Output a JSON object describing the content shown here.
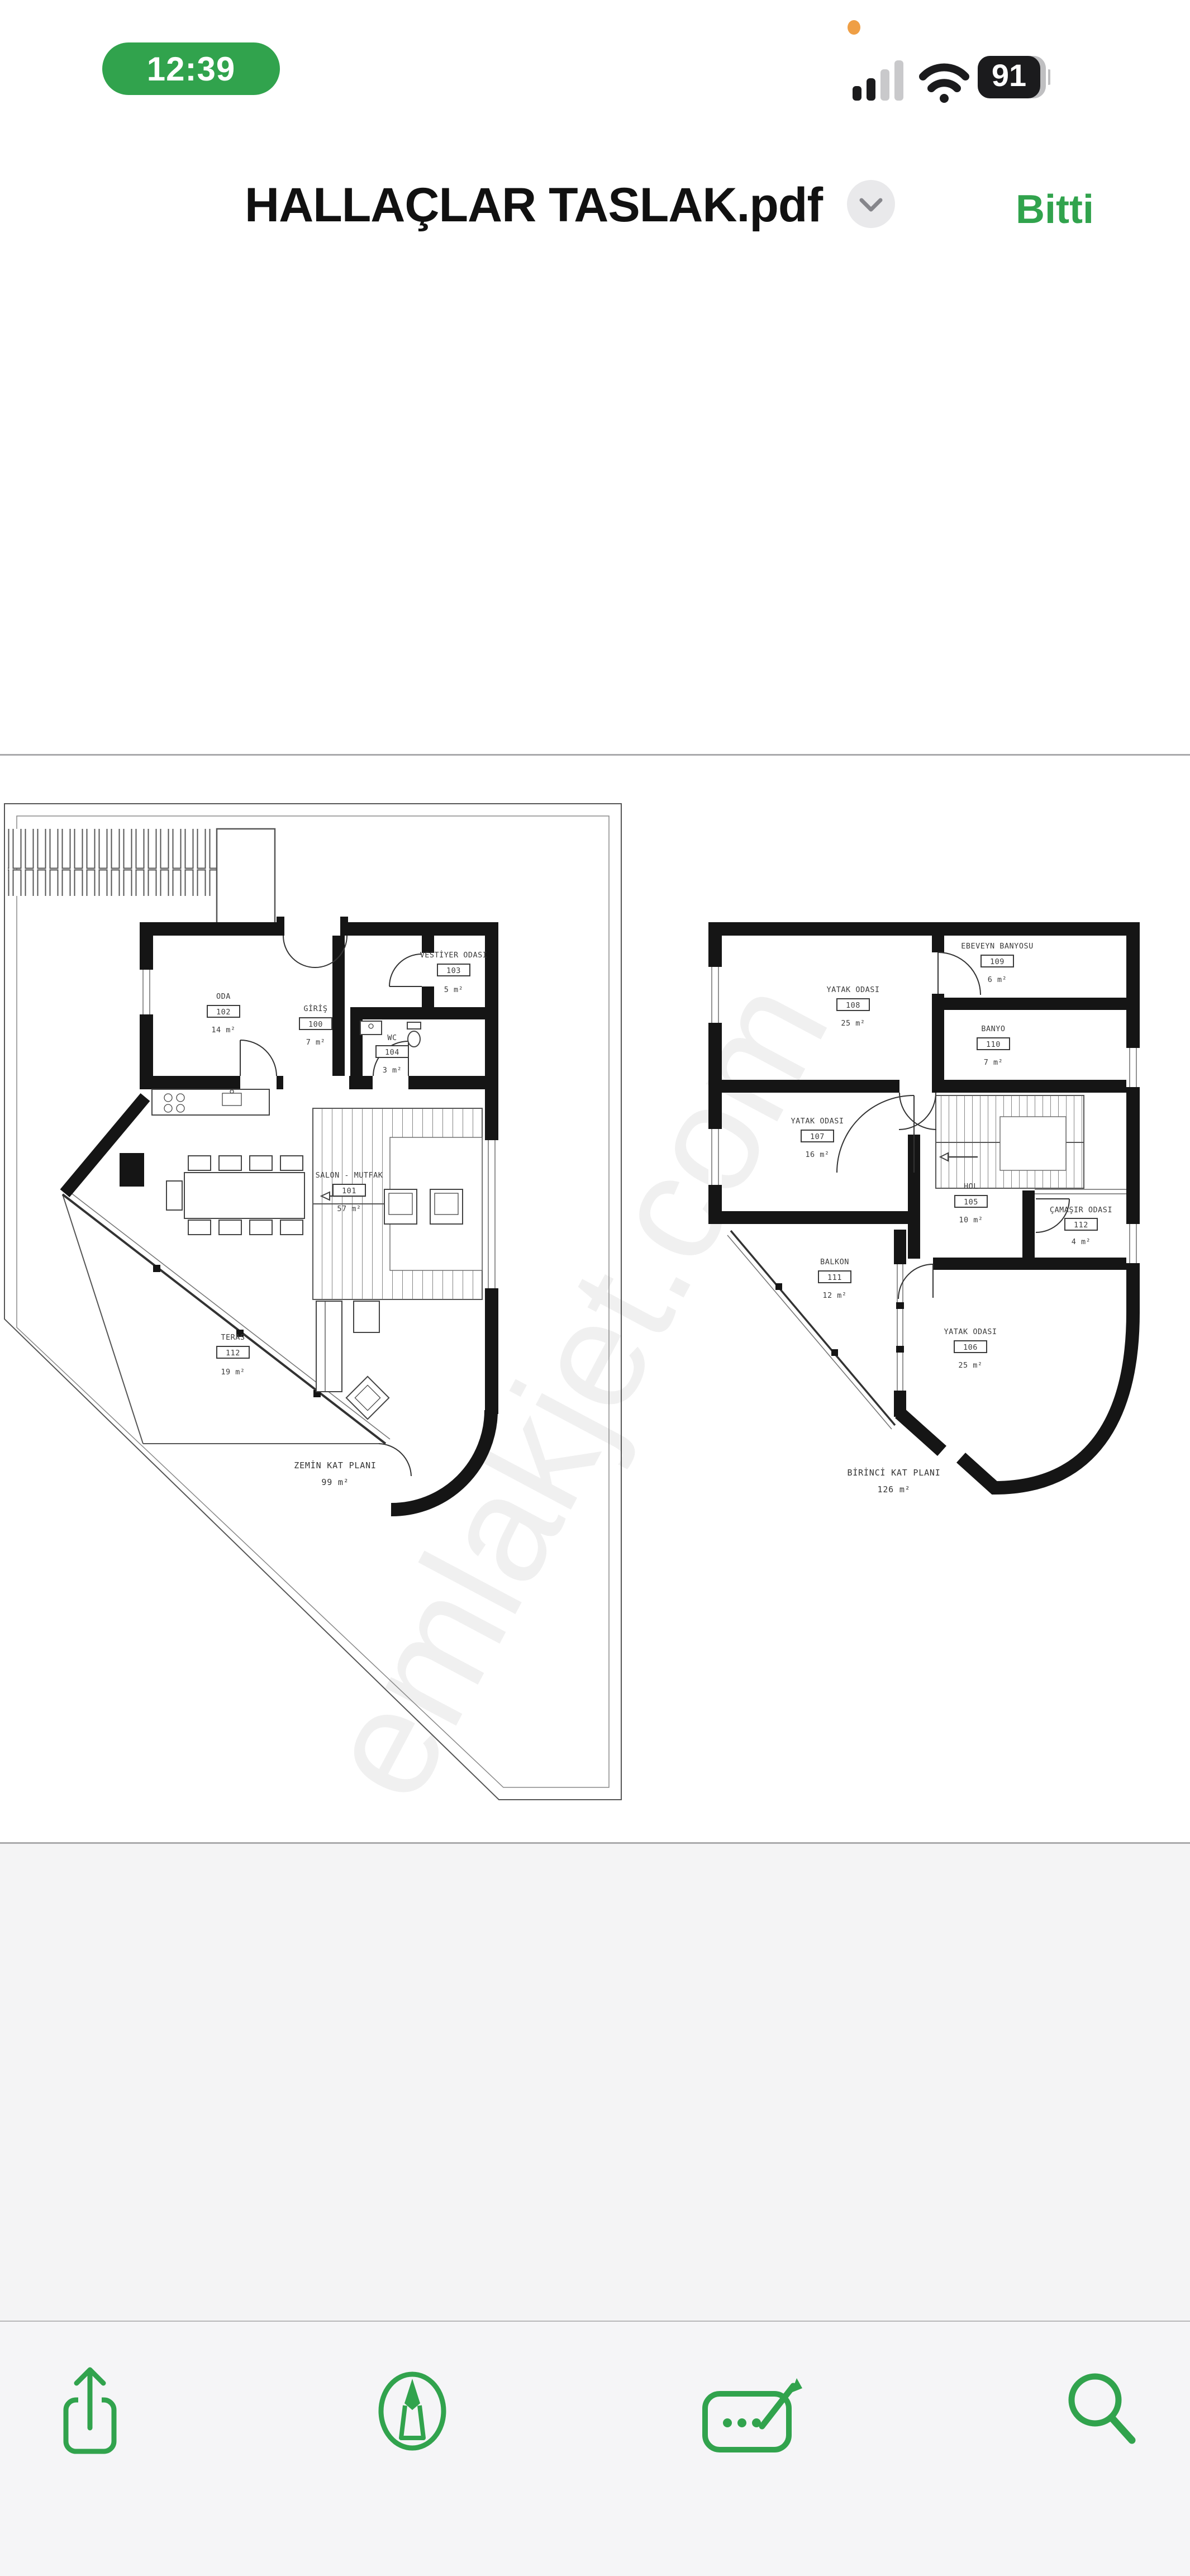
{
  "status_bar": {
    "time": "12:39",
    "battery": "91"
  },
  "header": {
    "title": "HALLAÇLAR TASLAK.pdf",
    "done_label": "Bitti"
  },
  "watermark": "emlakjet.com",
  "plans": [
    {
      "title": "ZEMİN KAT PLANI",
      "area": "99 m²",
      "rooms": [
        {
          "label": "ODA",
          "no": "102",
          "area": "14 m²"
        },
        {
          "label": "GİRİŞ",
          "no": "100",
          "area": "7 m²"
        },
        {
          "label": "VESTİYER ODASI",
          "no": "103",
          "area": "5 m²"
        },
        {
          "label": "WC",
          "no": "104",
          "area": "3 m²"
        },
        {
          "label": "SALON - MUTFAK",
          "no": "101",
          "area": "57 m²"
        },
        {
          "label": "TERAS",
          "no": "112",
          "area": "19 m²"
        }
      ]
    },
    {
      "title": "BİRİNCİ KAT PLANI",
      "area": "126 m²",
      "rooms": [
        {
          "label": "YATAK ODASI",
          "no": "108",
          "area": "25 m²"
        },
        {
          "label": "EBEVEYN BANYOSU",
          "no": "109",
          "area": "6 m²"
        },
        {
          "label": "BANYO",
          "no": "110",
          "area": "7 m²"
        },
        {
          "label": "YATAK ODASI",
          "no": "107",
          "area": "16 m²"
        },
        {
          "label": "HOL",
          "no": "105",
          "area": "10 m²"
        },
        {
          "label": "ÇAMAŞIR ODASI",
          "no": "112",
          "area": "4 m²"
        },
        {
          "label": "BALKON",
          "no": "111",
          "area": "12 m²"
        },
        {
          "label": "YATAK ODASI",
          "no": "106",
          "area": "25 m²"
        }
      ]
    }
  ],
  "toolbar": {
    "icons": [
      "share-icon",
      "markup-pen-icon",
      "signature-form-icon",
      "search-icon"
    ]
  },
  "colors": {
    "accent_green": "#31A34D",
    "status_orange": "#EF9F45",
    "wall_black": "#151515"
  }
}
